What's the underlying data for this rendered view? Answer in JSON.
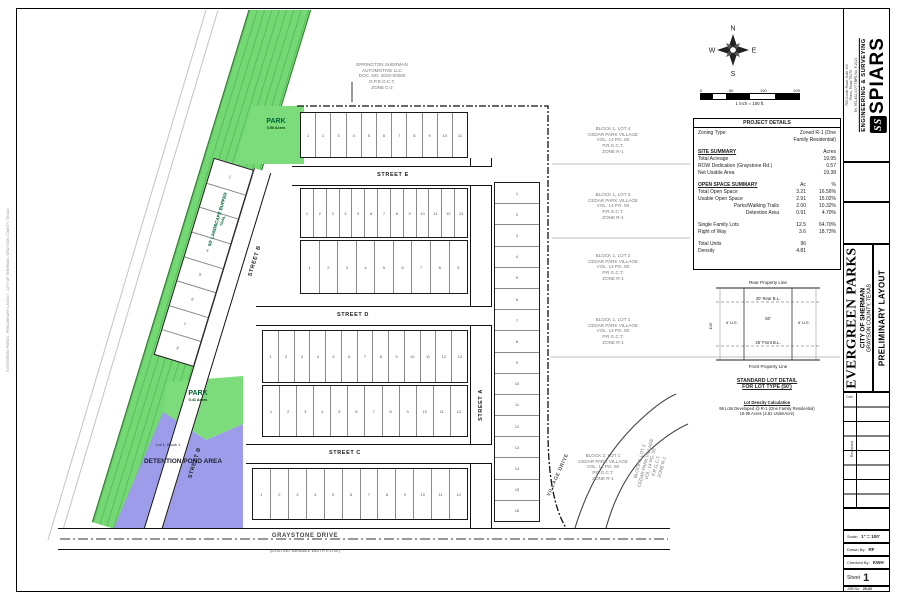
{
  "sheet": {
    "firm": {
      "name": "SPIARS",
      "tagline": "ENGINEERING & SURVEYING",
      "address_lines": [
        "765 Custer Road, Suite 100",
        "Plano, Texas 75075",
        "Tel. 972-422-0077  TBPE No. F-2121"
      ]
    },
    "project": {
      "name": "EVERGREEN PARKS",
      "city": "CITY OF SHERMAN",
      "county": "GRAYSON COUNTY, TEXAS",
      "sheet_title": "PRELIMINARY LAYOUT"
    },
    "revisions": {
      "label": "Revisions",
      "date_label": "Date"
    },
    "info": {
      "scale_label": "Scale:",
      "scale_value": "1\" = 100'",
      "drawn_label": "Drawn By:",
      "drawn_value": "RF",
      "checked_label": "Checked By:",
      "checked_value": "KWH",
      "sheet_label": "Sheet",
      "sheet_number": "1",
      "job_label": "JOB No.",
      "job_value": "20-02"
    },
    "plot_stamp": "EVERGREEN PARKS - PRELIMINARY LAYOUT - CITY OF SHERMAN, GRAYSON COUNTY, TEXAS"
  },
  "compass": {
    "north": "N",
    "east": "E",
    "south": "S",
    "west": "W"
  },
  "scale_bar": {
    "ticks": [
      "0",
      "50",
      "100",
      "200"
    ],
    "caption": "1 inch = 100 ft."
  },
  "project_details": {
    "title": "PROJECT DETAILS",
    "zoning_label": "Zoning Type:",
    "zoning_value_1": "Zoned R-1 (One",
    "zoning_value_2": "Family Residential)",
    "site_summary_title": "SITE SUMMARY",
    "site_summary_unit": "Acres",
    "site_rows": [
      {
        "l": "Total Acreage",
        "a": "19.95"
      },
      {
        "l": "ROW Dedication (Graystone Rd.)",
        "a": "0.57"
      },
      {
        "l": "Net Usable Area",
        "a": "19.38"
      }
    ],
    "open_space_title": "OPEN SPACE SUMMARY",
    "col_ac": "Ac",
    "col_pct": "%",
    "open_rows": [
      {
        "l": "Total Open Space",
        "a": "3.21",
        "p": "16.56%"
      },
      {
        "l": "Usable Open Space",
        "a": "2.91",
        "p": "15.02%"
      },
      {
        "l": "Parks/Walking Trails",
        "a": "2.00",
        "p": "10.32%",
        "ind": true
      },
      {
        "l": "Detention Area",
        "a": "0.91",
        "p": "4.70%",
        "ind": true
      },
      {
        "sp": true
      },
      {
        "l": "Single Family Lots",
        "a": "12.5",
        "p": "64.70%"
      },
      {
        "l": "Right of Way",
        "a": "3.6",
        "p": "18.73%"
      },
      {
        "sp": true
      },
      {
        "l": "Total Units",
        "a": "96",
        "p": ""
      },
      {
        "l": "Density",
        "a": "4.81",
        "p": ""
      }
    ]
  },
  "lot_detail": {
    "rear_pl": "Rear Property Line",
    "rear_bl": "20' Rear B.L.",
    "ue": "5' U.E.",
    "front_bl": "25' Front B.L.",
    "front_pl": "Front Property Line",
    "width": "50'",
    "depth": "105'",
    "title_1": "STANDARD LOT DETAIL",
    "title_2": "FOR LOT TYPE (50')"
  },
  "lot_density": {
    "line1": "Lot Density Calculation",
    "line2": "96 Lots Developed @ R-1 (One Family Residential)",
    "line3": "19.95 Acres (4.81 Units/Acre)"
  },
  "adjacent_tracts": {
    "auto": [
      "ERRINGTON SHERMAN",
      "AUTOMOTIVE LLC",
      "DOC. NO. 2020-00000",
      "O.P.R.G.C.T.",
      "ZONE C-2"
    ],
    "t1": [
      "BLOCK 1, LOT 4",
      "CEDAR PARK VILLAGE",
      "VOL. 14 PG. 50",
      "P.R.G.C.T.",
      "ZONE R-1"
    ],
    "t2": [
      "BLOCK 1, LOT 3",
      "CEDAR PARK VILLAGE",
      "VOL. 14 PG. 50",
      "P.R.G.C.T.",
      "ZONE R-1"
    ],
    "t3": [
      "BLOCK 1, LOT 2",
      "CEDAR PARK VILLAGE",
      "VOL. 14 PG. 50",
      "P.R.G.C.T.",
      "ZONE R-1"
    ],
    "t4": [
      "BLOCK 1, LOT 1",
      "CEDAR PARK VILLAGE",
      "VOL. 14 PG. 50",
      "P.R.G.C.T.",
      "ZONE R-1"
    ],
    "t5": [
      "BLOCK 2, LOT 1",
      "CEDAR PARK VILLAGE",
      "VOL. 14 PG. 50",
      "P.R.G.C.T.",
      "ZONE R-1"
    ],
    "t6": [
      "BLOCK 2, LOT 2",
      "CEDAR PARK VILLAGE",
      "VOL. 14 PG. 50",
      "P.R.G.C.T.",
      "ZONE R-1"
    ]
  },
  "map": {
    "streets": {
      "a": "STREET A",
      "b": "STREET B",
      "c": "STREET C",
      "d": "STREET D",
      "e": "STREET E",
      "village": "VILLAGE DRIVE",
      "graystone": "GRAYSTONE DRIVE",
      "graystone_sub": "(EXISTING VARIABLE WIDTH R.O.W.)"
    },
    "buffer_label": "50' LANDSCAPE BUFFER",
    "buffer_sub": "TRAIL",
    "park_north": {
      "label": "PARK",
      "sub": "0.50 Acres"
    },
    "park_south": {
      "label": "PARK",
      "sub": "0.41 Acres"
    },
    "pond": {
      "lot": "Lot 1, Block 1",
      "label": "DETENTION POND AREA"
    },
    "lot_blocks": [
      {
        "name": "row-north",
        "lots": 11
      },
      {
        "name": "row-street-e-south",
        "lots": 13
      },
      {
        "name": "row-street-d-north",
        "lots": 9
      },
      {
        "name": "row-street-d-south",
        "lots": 13
      },
      {
        "name": "row-street-c-north",
        "lots": 12
      },
      {
        "name": "row-street-c-south",
        "lots": 12
      },
      {
        "name": "col-east",
        "lots": 16
      },
      {
        "name": "col-west",
        "lots": 8
      }
    ],
    "colors": {
      "park_green": "#7cdc7c",
      "pond_purple": "#9c9cea",
      "line": "#1a1a1a"
    }
  }
}
